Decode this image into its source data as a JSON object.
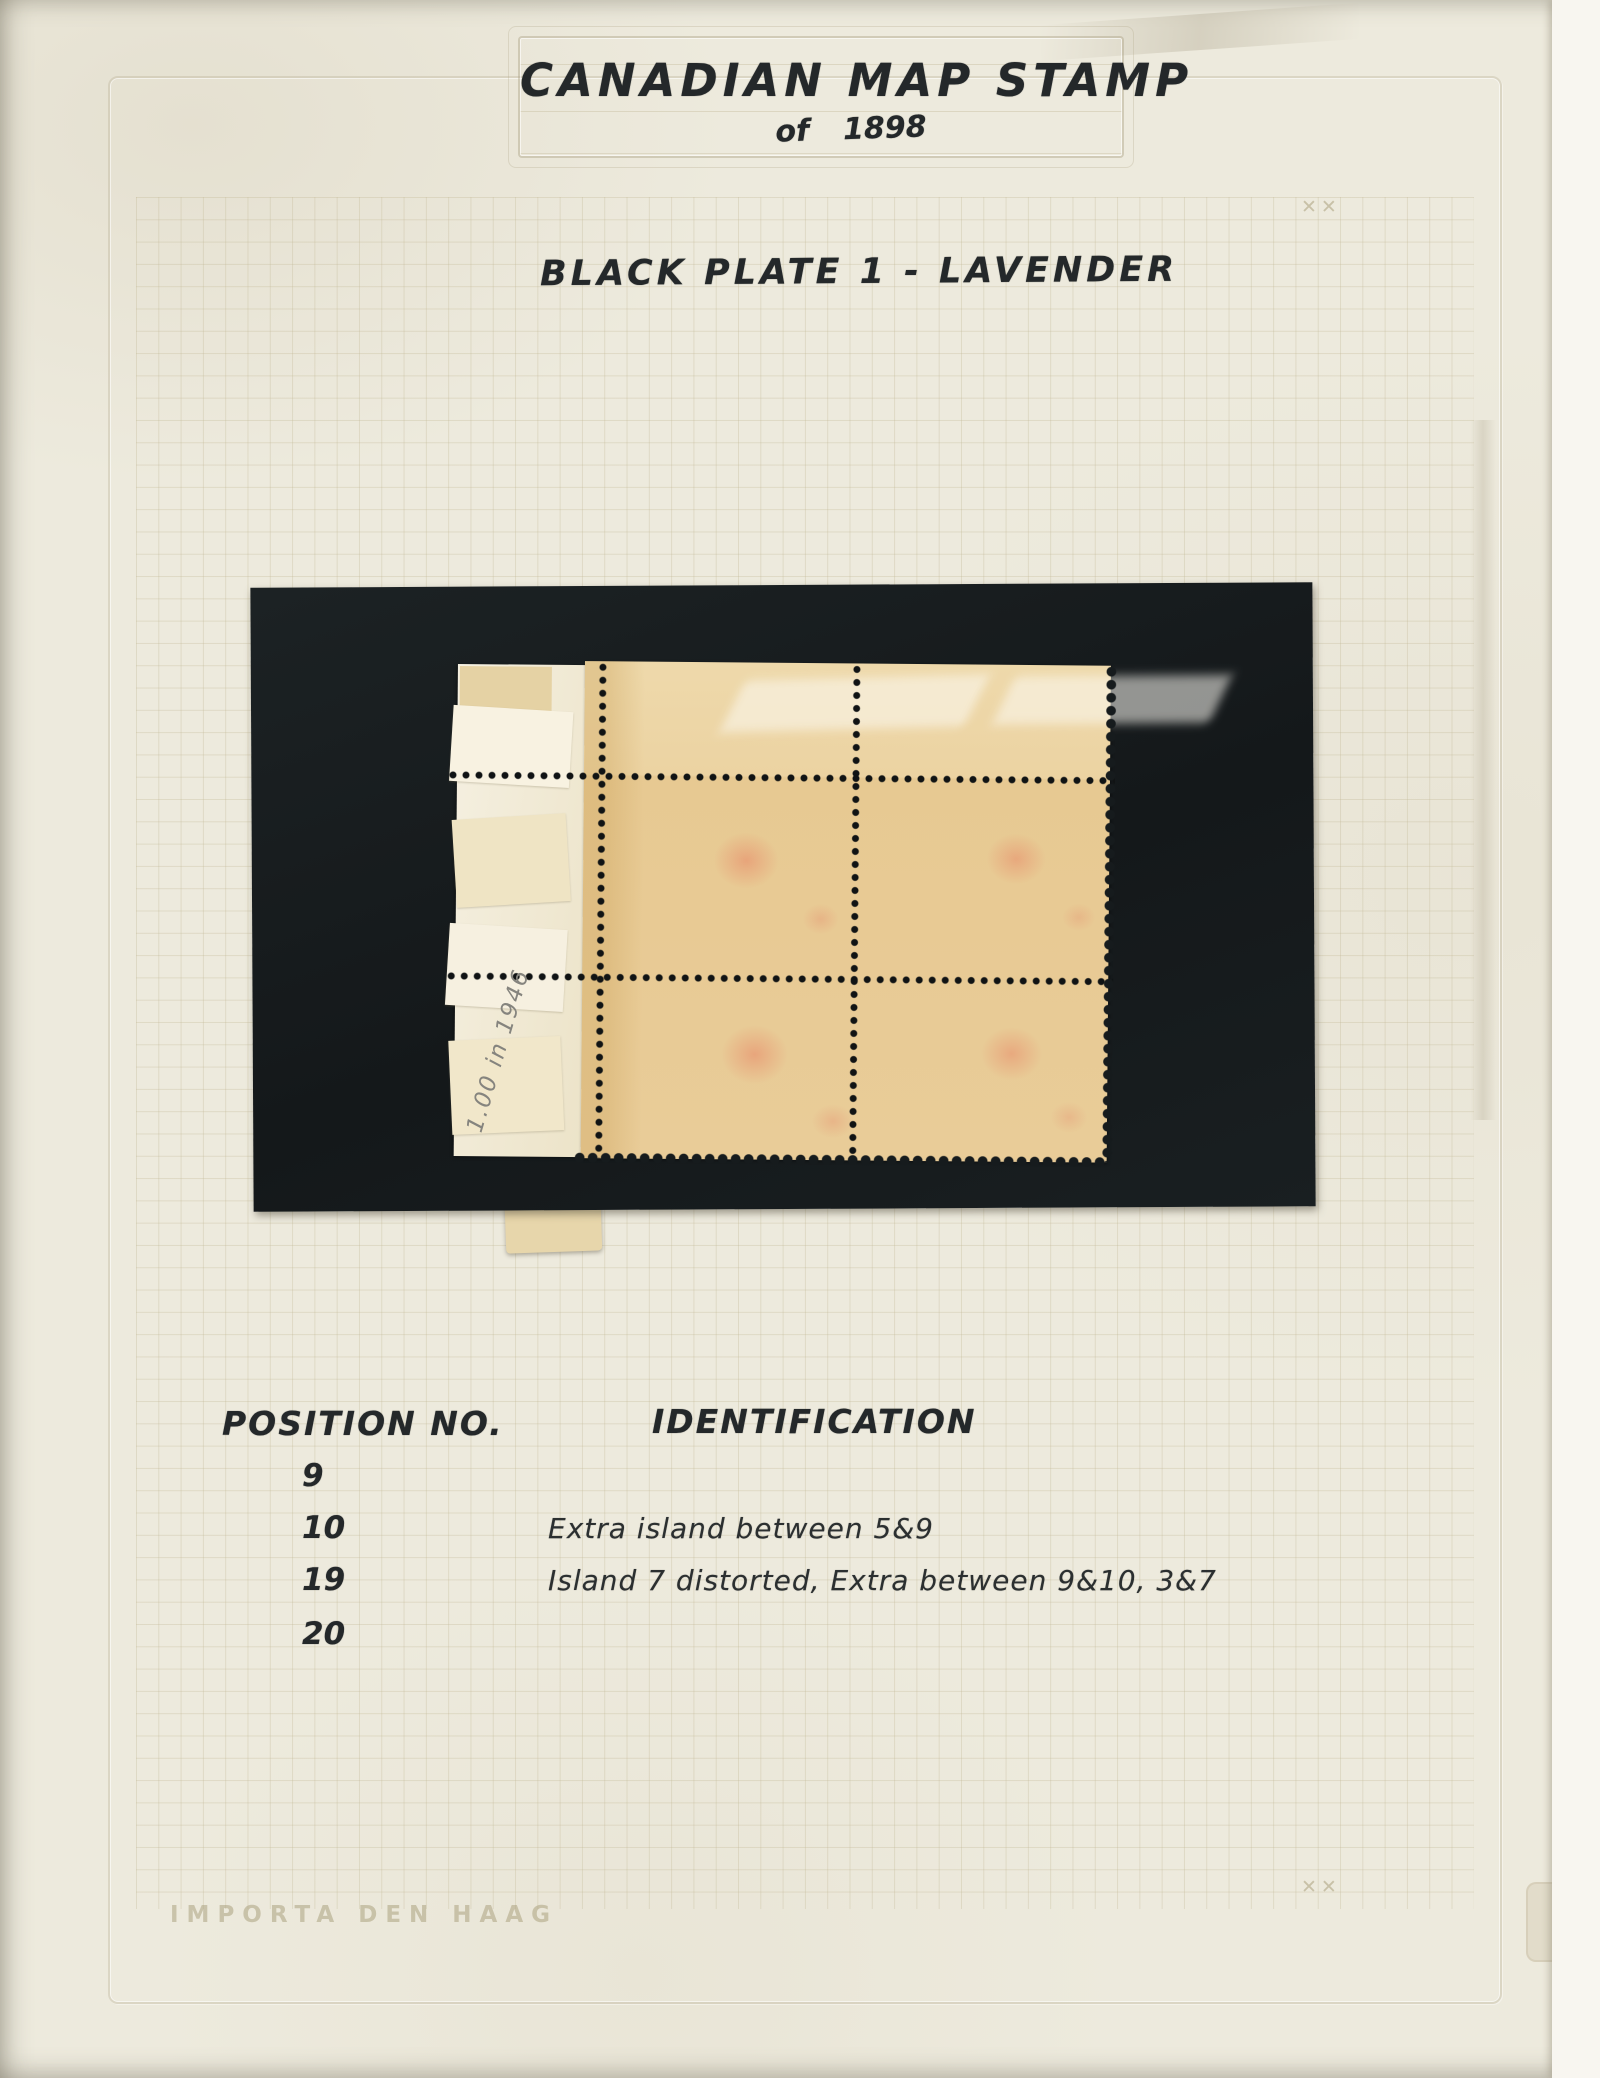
{
  "album_page": {
    "title": "CANADIAN MAP STAMP",
    "of_word": "of",
    "year": "1898",
    "plate_line": "BLACK PLATE 1 - LAVENDER",
    "manufacturer_mark": "IMPORTA DEN HAAG",
    "corner_register_marks": "✕✕"
  },
  "mount": {
    "pencil_note": "1.00 in 1946"
  },
  "positions_table": {
    "position_header": "POSITION NO.",
    "identification_header": "IDENTIFICATION",
    "rows": [
      {
        "position": "9",
        "identification": ""
      },
      {
        "position": "10",
        "identification": "Extra island between 5&9"
      },
      {
        "position": "19",
        "identification": "Island 7 distorted, Extra between 9&10, 3&7"
      },
      {
        "position": "20",
        "identification": ""
      }
    ]
  },
  "colors": {
    "page_background": "#edeadd",
    "grid_line": "#c1b794",
    "mount_black": "#14181a",
    "gum_tan": "#e9cc98",
    "selvage_white": "#f5f0e1",
    "handwriting_ink": "#24282a",
    "pencil_gray": "#85847e",
    "pink_showthrough": "#e88062"
  }
}
